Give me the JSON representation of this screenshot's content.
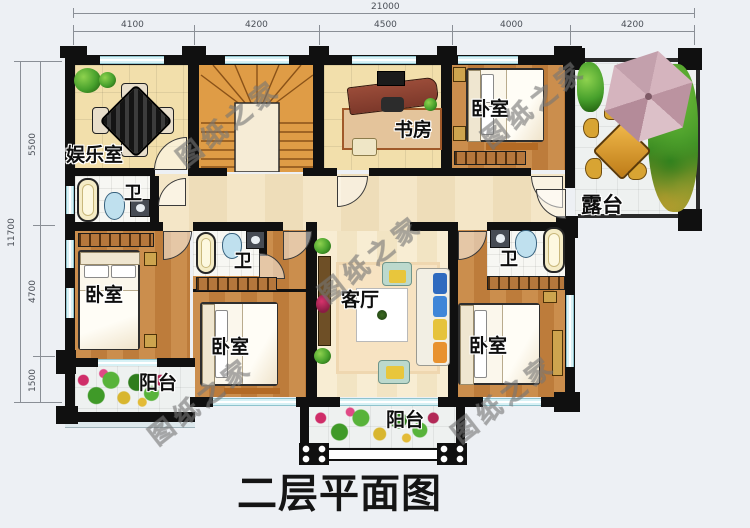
{
  "title": "二层平面图",
  "watermark": {
    "text": "图纸之家"
  },
  "dimensions": {
    "top": {
      "total": "21000",
      "segments": [
        "4100",
        "4200",
        "4500",
        "4000",
        "4200"
      ]
    },
    "left": {
      "total": "11700",
      "segments": [
        "5500",
        "4700",
        "1500"
      ]
    }
  },
  "rooms": {
    "entertainment": "娱乐室",
    "study": "书房",
    "bedroom": "卧室",
    "bath": "卫",
    "terrace": "露台",
    "living": "客厅",
    "balcony": "阳台"
  }
}
